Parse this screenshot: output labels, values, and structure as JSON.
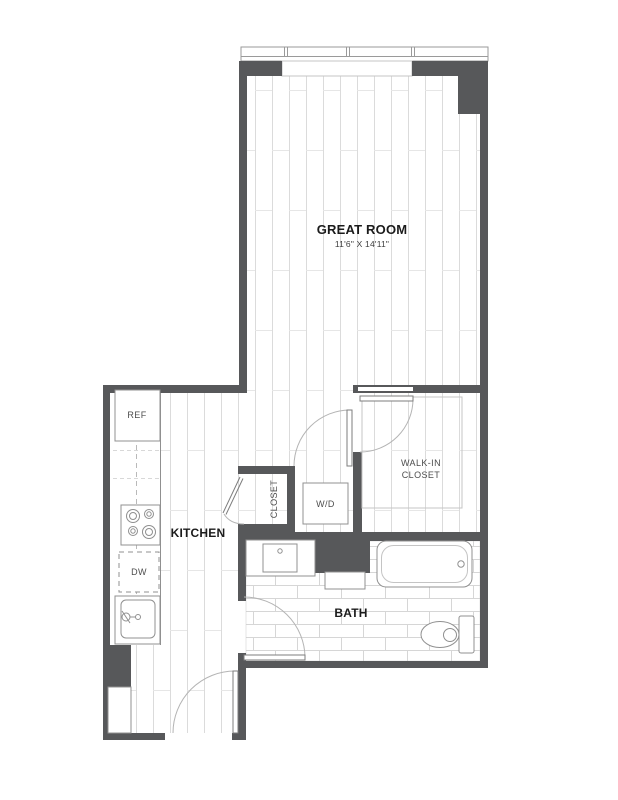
{
  "plan": {
    "type": "apartment-floor-plan",
    "colors": {
      "wall": "#57585a",
      "floor_line": "#dbdbdb",
      "tile_line": "#d6d6d6",
      "fixture_line": "#909090",
      "room_label": "#1b1b1b",
      "fixture_label": "#4d4d4d"
    },
    "rooms": {
      "great_room": {
        "label": "GREAT ROOM",
        "dimensions": "11'6\" X 14'11\""
      },
      "kitchen": {
        "label": "KITCHEN"
      },
      "bath": {
        "label": "BATH"
      },
      "walk_in_closet": {
        "label_line1": "WALK-IN",
        "label_line2": "CLOSET"
      },
      "closet": {
        "label": "CLOSET"
      },
      "laundry": {
        "label": "W/D"
      }
    },
    "fixtures": {
      "refrigerator": "REF",
      "dishwasher": "DW"
    }
  }
}
